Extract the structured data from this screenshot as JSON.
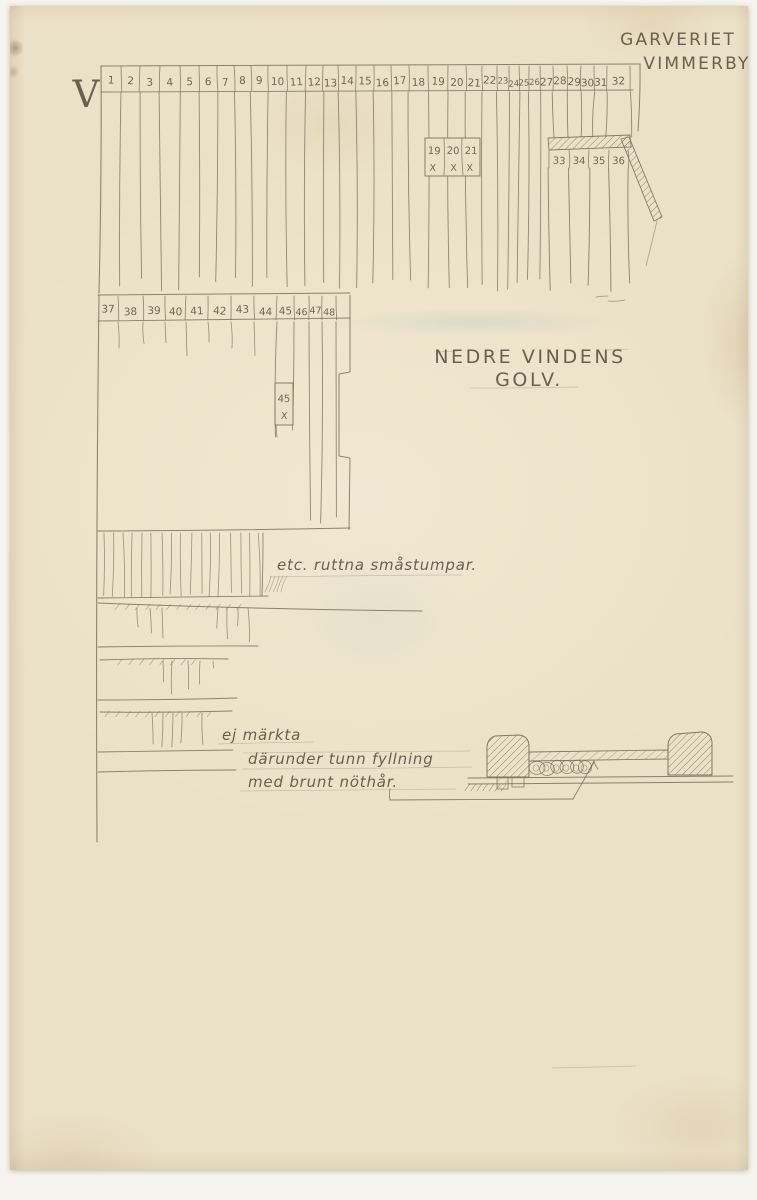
{
  "document": {
    "sheet_letter": "V",
    "title_line1": "GARVERIET",
    "title_line2": "VIMMERBY",
    "caption_line1": "NEDRE VINDENS",
    "caption_line2": "GOLV."
  },
  "plan": {
    "top_row_numbers": [
      "1",
      "2",
      "3",
      "4",
      "5",
      "6",
      "7",
      "8",
      "9",
      "10",
      "11",
      "12",
      "13",
      "14",
      "15",
      "16",
      "17",
      "18",
      "19",
      "20",
      "21",
      "22",
      "23",
      "24",
      "25",
      "26",
      "27",
      "28",
      "29",
      "30",
      "31",
      "32"
    ],
    "patch_numbers": [
      "19",
      "20",
      "21"
    ],
    "patch_marks": [
      "X",
      "X",
      "X"
    ],
    "right_numbers": [
      "33",
      "34",
      "35",
      "36"
    ],
    "second_row_numbers": [
      "37",
      "38",
      "39",
      "40",
      "41",
      "42",
      "43",
      "44",
      "45",
      "46",
      "47",
      "48"
    ],
    "board45_number": "45",
    "board45_mark": "X"
  },
  "annotations": {
    "stumps_note": "etc. ruttna småstumpar.",
    "unmarked_note": "ej märkta",
    "filling_note_line1": "därunder tunn fyllning",
    "filling_note_line2": "med brunt nöthår."
  },
  "colors": {
    "paper": "#ebe1c8",
    "pencil": "#7a6e5c",
    "ink_text": "#6b5f4f"
  }
}
